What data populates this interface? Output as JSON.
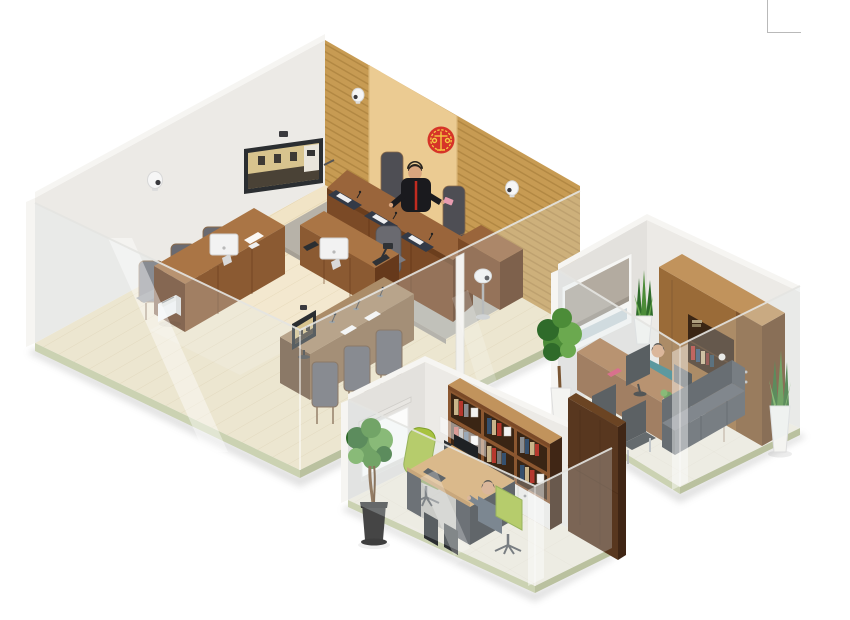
{
  "meta": {
    "description": "Isometric 3D cutaway render of a smart-court complex: a digital courtroom with judge bench, court emblem, monitoring cameras and video wall, plus two adjacent glass-fronted offices",
    "canvas": {
      "width": 850,
      "height": 620
    }
  },
  "rooms": {
    "courtroom": {
      "name": "Digital courtroom",
      "objects": [
        "wood slat feature wall",
        "light wood emblem panel",
        "red and gold court emblem",
        "judge bench with three dark desk mats, papers and microphones",
        "judge figure in black robe with red trim",
        "high-back judge chairs",
        "bench side return desk",
        "clerk desk with white monitor, phone and document camera",
        "clerk chair",
        "advocate desk with white monitor and papers",
        "three high-back advocate chairs",
        "paper shredder",
        "litigant table with video monitor, microphones and papers",
        "three litigant chairs",
        "wall-mounted TV showing remote courtroom video feed",
        "camera on top of TV",
        "three wall-mounted PTZ cameras",
        "white camera on floor stand",
        "light wood plank floor",
        "gray dais carpet",
        "glass front walls with mullion post"
      ]
    },
    "clerk_office": {
      "name": "Clerks' office",
      "objects": [
        "double workstation desk with two monitors, divider, keyboard and PC towers",
        "green office chair (empty)",
        "green office chair with seated clerk in gray suit",
        "bookshelf wall unit with books, framed photos and white cabinet doors",
        "tall dark wood cabinet",
        "white projection screen on roller",
        "potted money-tree plant in dark pot",
        "glossy tile floor",
        "glass front walls"
      ]
    },
    "private_office": {
      "name": "Judge's office",
      "objects": [
        "window with gray roller blind",
        "wall bookcase unit with book niche",
        "executive desk with monitor, red book and small plant",
        "seated person in teal jacket",
        "black desk chair",
        "black pedestal unit",
        "two black guest chairs with chrome legs",
        "dark gray sofa",
        "two snake plants in white planters",
        "leafy floor plant in white pot",
        "glossy tile floor",
        "glass front walls"
      ]
    }
  },
  "decor": {
    "corner_mark": "thin gray L-shaped line, top-right corner"
  },
  "colors": {
    "bg": "#FFFFFF",
    "wall": "#ECEAE6",
    "wallShade": "#E3E1DD",
    "wallLight": "#F6F5F2",
    "wallEdge": "#D8D5D0",
    "slat": "#C79B53",
    "slatLine": "#9E7533",
    "panel": "#EBCB92",
    "panelEdge": "#D9B678",
    "emblemRed": "#D63428",
    "emblemGold": "#F5C842",
    "floorWood": "#F1E4C6",
    "floorLine": "#E0D0A9",
    "rim": "#CBD2B2",
    "rimDark": "#BAC19F",
    "carpet": "#B7B2A8",
    "carpetEdge": "#A6A095",
    "benchFront": "#7B4A26",
    "benchTop": "#9A653B",
    "benchSide": "#5C3114",
    "woodMid": "#8B5A32",
    "woodTop": "#AA7545",
    "woodDark": "#66391B",
    "tableWood": "#8F6F4E",
    "tableTop": "#AB8C68",
    "tableDark": "#6E5138",
    "chair": "#6A6A70",
    "chairDark": "#4E4E54",
    "chairSeat": "#7B7B81",
    "screenDark": "#2B2E31",
    "screenImg": "#D8C48E",
    "screenContent": "#4A4236",
    "glass": "rgba(225,235,240,0.26)",
    "glassStreak": "rgba(255,255,255,0.42)",
    "glassEdge": "#E4E4E1",
    "tile": "#F2ECDF",
    "tileLine": "#E3DCCA",
    "shelfWood": "#8B5730",
    "shelfBack": "#3A2514",
    "cabWhite": "#EFEDE8",
    "darkCab": "#58371F",
    "darkCabSide": "#402615",
    "cabinet": "#9A6B38",
    "cabinetTop": "#C1935C",
    "cabinetDark": "#6B4423",
    "greenChair": "#A8C23F",
    "greenChairDark": "#7FA02A",
    "suit": "#5A6470",
    "teal": "#2E7D84",
    "sofa": "#54585D",
    "sofaDark": "#3F4348",
    "sofaTop": "#60656B",
    "black": "#26292C",
    "silver": "#B9BCBE",
    "plant": "#4C8C38",
    "plantDark": "#2F6B2A",
    "plantLight": "#6BA94F",
    "trunk": "#7A5633",
    "potWhite": "#F4F4F1",
    "potDark": "#454545",
    "blind": "#B3ABA0",
    "blindBar": "#9D958A",
    "windowGlass": "#CBD5D9",
    "skin": "#D9A57E",
    "hair": "#28231E",
    "robe": "#1A1A1E",
    "tie": "#C22B20",
    "pink": "#E89CB0",
    "bookRed": "#B5382E",
    "bookBlue": "#35506E",
    "bookTan": "#C9B48A",
    "deskTop2": "#D8A869",
    "deskBase": "#45484D",
    "deskBase2": "#35383C",
    "camWhite": "#F6F6F6",
    "camLens": "#3A3A3E",
    "cornerMark": "#B9B9B9",
    "shadow": "#9A9A9A"
  }
}
